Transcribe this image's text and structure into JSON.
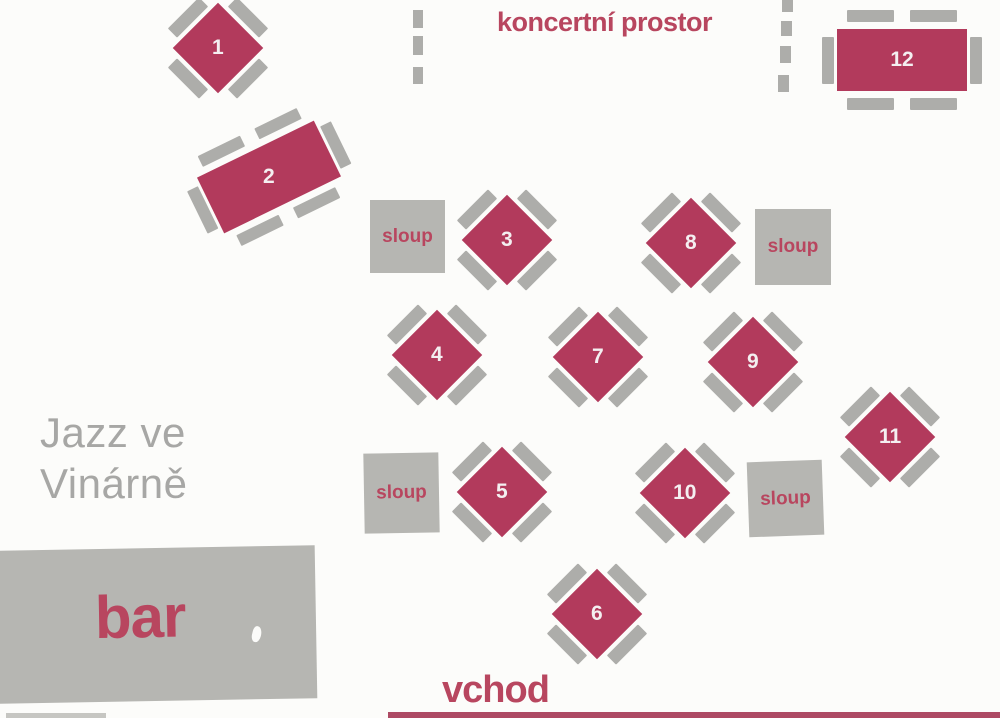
{
  "title": {
    "line1": "Jazz ve",
    "line2": "Vinárně"
  },
  "labels": {
    "concert_area": "koncertní prostor",
    "entrance": "vchod",
    "bar": "bar",
    "pillar": "sloup"
  },
  "colors": {
    "table_fill": "#b23a5c",
    "accent_text": "#b8465f",
    "chair_gray": "#adadaa",
    "pillar_gray": "#b6b6b2",
    "title_gray": "#a7a7a5",
    "paper": "#fcfcfa",
    "strip_red": "#ad4a64"
  },
  "tables": [
    {
      "number": "1",
      "shape": "square-diagonal",
      "seats": 4
    },
    {
      "number": "2",
      "shape": "rectangle-rotated",
      "seats": 6
    },
    {
      "number": "3",
      "shape": "square-diagonal",
      "seats": 4
    },
    {
      "number": "4",
      "shape": "square-diagonal",
      "seats": 4
    },
    {
      "number": "5",
      "shape": "square-diagonal",
      "seats": 4
    },
    {
      "number": "6",
      "shape": "square-diagonal",
      "seats": 4
    },
    {
      "number": "7",
      "shape": "square-diagonal",
      "seats": 4
    },
    {
      "number": "8",
      "shape": "square-diagonal",
      "seats": 4
    },
    {
      "number": "9",
      "shape": "square-diagonal",
      "seats": 4
    },
    {
      "number": "10",
      "shape": "square-diagonal",
      "seats": 4
    },
    {
      "number": "11",
      "shape": "square-diagonal",
      "seats": 4
    },
    {
      "number": "12",
      "shape": "rectangle",
      "seats": 6
    }
  ]
}
